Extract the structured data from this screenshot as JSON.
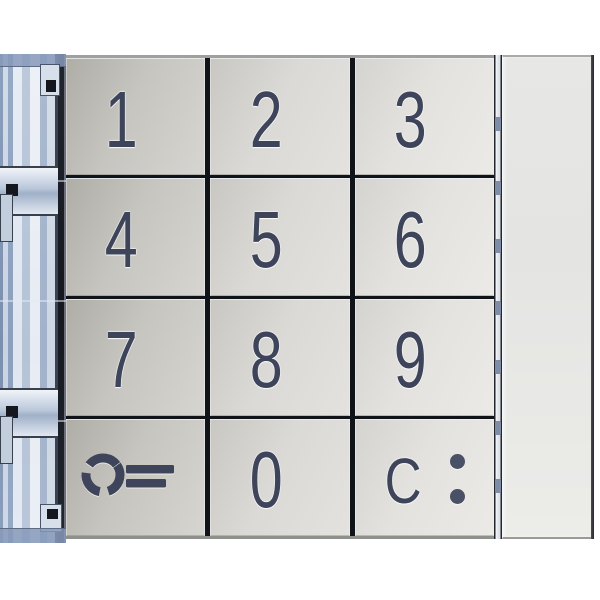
{
  "keypad": {
    "rows": 4,
    "cols": 3,
    "keys": [
      {
        "id": "1",
        "label": "1"
      },
      {
        "id": "2",
        "label": "2"
      },
      {
        "id": "3",
        "label": "3"
      },
      {
        "id": "4",
        "label": "4"
      },
      {
        "id": "5",
        "label": "5"
      },
      {
        "id": "6",
        "label": "6"
      },
      {
        "id": "7",
        "label": "7"
      },
      {
        "id": "8",
        "label": "8"
      },
      {
        "id": "9",
        "label": "9"
      },
      {
        "id": "unlock",
        "label": "",
        "icon": "key-icon"
      },
      {
        "id": "0",
        "label": "0"
      },
      {
        "id": "clear",
        "label": "C",
        "icon": "colon-dots-icon"
      }
    ]
  },
  "colors": {
    "digit": "#3e4459",
    "key_face_dark": "#aeada6",
    "key_face_light": "#ebeae6",
    "divider": "#101318",
    "rail_blue_light": "#dfe6f0",
    "rail_blue_mid": "#9fb0c8",
    "rail_blue_dark": "#1b1e25",
    "blank_panel": "#e7e7e5",
    "background": "#ffffff"
  }
}
